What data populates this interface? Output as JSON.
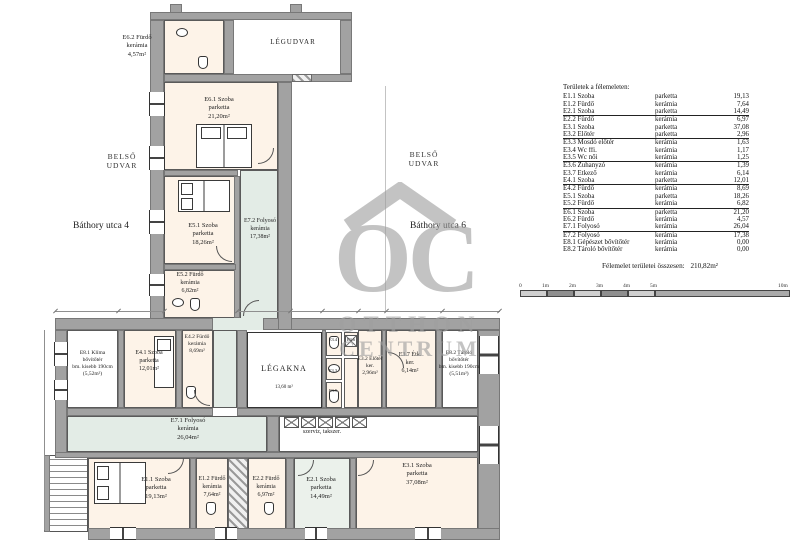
{
  "plan": {
    "streets": {
      "left": "Báthory utca 4",
      "right": "Báthory utca 6"
    },
    "courtyards": {
      "left": [
        "BELSŐ",
        "UDVAR"
      ],
      "right": [
        "BELSŐ",
        "UDVAR"
      ],
      "top": "LÉGUDVAR"
    },
    "labels": {
      "e62": [
        "E6.2 Fürdő",
        "kerámia",
        "4,57m²"
      ],
      "e61": [
        "E6.1 Szoba",
        "parketta",
        "21,20m²"
      ],
      "e51": [
        "E5.1 Szoba",
        "parketta",
        "18,26m²"
      ],
      "e72": [
        "E7.2 Folyosó",
        "kerámia",
        "17,38m²"
      ],
      "e52": [
        "E5.2 Fürdő",
        "kerámia",
        "6,82m²"
      ],
      "e42": [
        "E4.2 Fürdő",
        "kerámia",
        "8,69m²"
      ],
      "e81": [
        "E8.1 Klíma",
        "bővítőtér",
        "bm. kisebb 190cm",
        "(5,52m²)"
      ],
      "e41": [
        "E4.1 Szoba",
        "parketta",
        "12,01m²"
      ],
      "legakna": [
        "LÉGAKNA",
        "13,60 m²"
      ],
      "e34": "E3.4",
      "e36": "E3.6",
      "e33": "E3.3",
      "e35": "E3.5",
      "e32": [
        "E3.2 Előtér",
        "ker.",
        "2,96m²"
      ],
      "e37": [
        "E3.7 Étk.",
        "ker.",
        "6,14m²"
      ],
      "e82": [
        "E8.2 Tároló",
        "bővítőtér",
        "bm. kisebb 190cm",
        "(5,51m²)"
      ],
      "e71": [
        "E7.1 Folyosó",
        "kerámia",
        "26,04m²"
      ],
      "szerviz": "szerviz, takszer.",
      "e11": [
        "E1.1 Szoba",
        "parketta",
        "19,13m²"
      ],
      "e12": [
        "E1.2 Fürdő",
        "kerámia",
        "7,64m²"
      ],
      "e22": [
        "E2.2 Fürdő",
        "kerámia",
        "6,97m²"
      ],
      "e21": [
        "E2.1 Szoba",
        "parketta",
        "14,49m²"
      ],
      "e31": [
        "E3.1 Szoba",
        "parketta",
        "37,08m²"
      ]
    }
  },
  "legend": {
    "header": "Területek a félemeleten:",
    "rows": [
      {
        "name": "E1.1 Szoba",
        "material": "parketta",
        "value": "19,13"
      },
      {
        "name": "E1.2 Fürdő",
        "material": "kerámia",
        "value": "7,64"
      },
      {
        "name": "E2.1 Szoba",
        "material": "parketta",
        "value": "14,49",
        "u": 1
      },
      {
        "name": "E2.2 Fürdő",
        "material": "kerámia",
        "value": "6,97"
      },
      {
        "name": "E3.1 Szoba",
        "material": "parketta",
        "value": "37,08"
      },
      {
        "name": "E3.2 Előtér",
        "material": "parketta",
        "value": "2,96",
        "u": 1
      },
      {
        "name": "E3.3 Mosdó előtér",
        "material": "kerámia",
        "value": "1,63"
      },
      {
        "name": "E3.4 Wc ffi.",
        "material": "kerámia",
        "value": "1,17"
      },
      {
        "name": "E3.5 Wc női",
        "material": "kerámia",
        "value": "1,25",
        "u": 1
      },
      {
        "name": "E3.6 Zuhanyzó",
        "material": "kerámia",
        "value": "1,39"
      },
      {
        "name": "E3.7 Étkező",
        "material": "kerámia",
        "value": "6,14"
      },
      {
        "name": "E4.1 Szoba",
        "material": "parketta",
        "value": "12,01",
        "u": 1
      },
      {
        "name": "E4.2 Fürdő",
        "material": "kerámia",
        "value": "8,69"
      },
      {
        "name": "E5.1 Szoba",
        "material": "parketta",
        "value": "18,26"
      },
      {
        "name": "E5.2 Fürdő",
        "material": "kerámia",
        "value": "6,82",
        "u": 1
      },
      {
        "name": "E6.1 Szoba",
        "material": "parketta",
        "value": "21,20"
      },
      {
        "name": "E6.2 Fürdő",
        "material": "kerámia",
        "value": "4,57"
      },
      {
        "name": "E7.1 Folyosó",
        "material": "kerámia",
        "value": "26,04",
        "u": 1
      },
      {
        "name": "E7.2 Folyosó",
        "material": "kerámia",
        "value": "17,38"
      },
      {
        "name": "E8.1 Gépészet bővítőtér",
        "material": "kerámia",
        "value": "0,00"
      },
      {
        "name": "E8.2 Tároló bővítőtér",
        "material": "kerámia",
        "value": "0,00"
      }
    ],
    "total_label": "Félemelet területei összesen:",
    "total_value": "210,82m²"
  },
  "scalebar": {
    "labels": [
      "0",
      "1m",
      "2m",
      "3m",
      "4m",
      "5m",
      "10m"
    ]
  },
  "watermark": {
    "initials": "OC",
    "line1": "OTTHON",
    "line2": "CENTRUM"
  },
  "colors": {
    "wall": "#a2a2a2",
    "room": "#fdf3e8",
    "corridor": "#e3ece6",
    "watermark": "#9f9f9f"
  }
}
